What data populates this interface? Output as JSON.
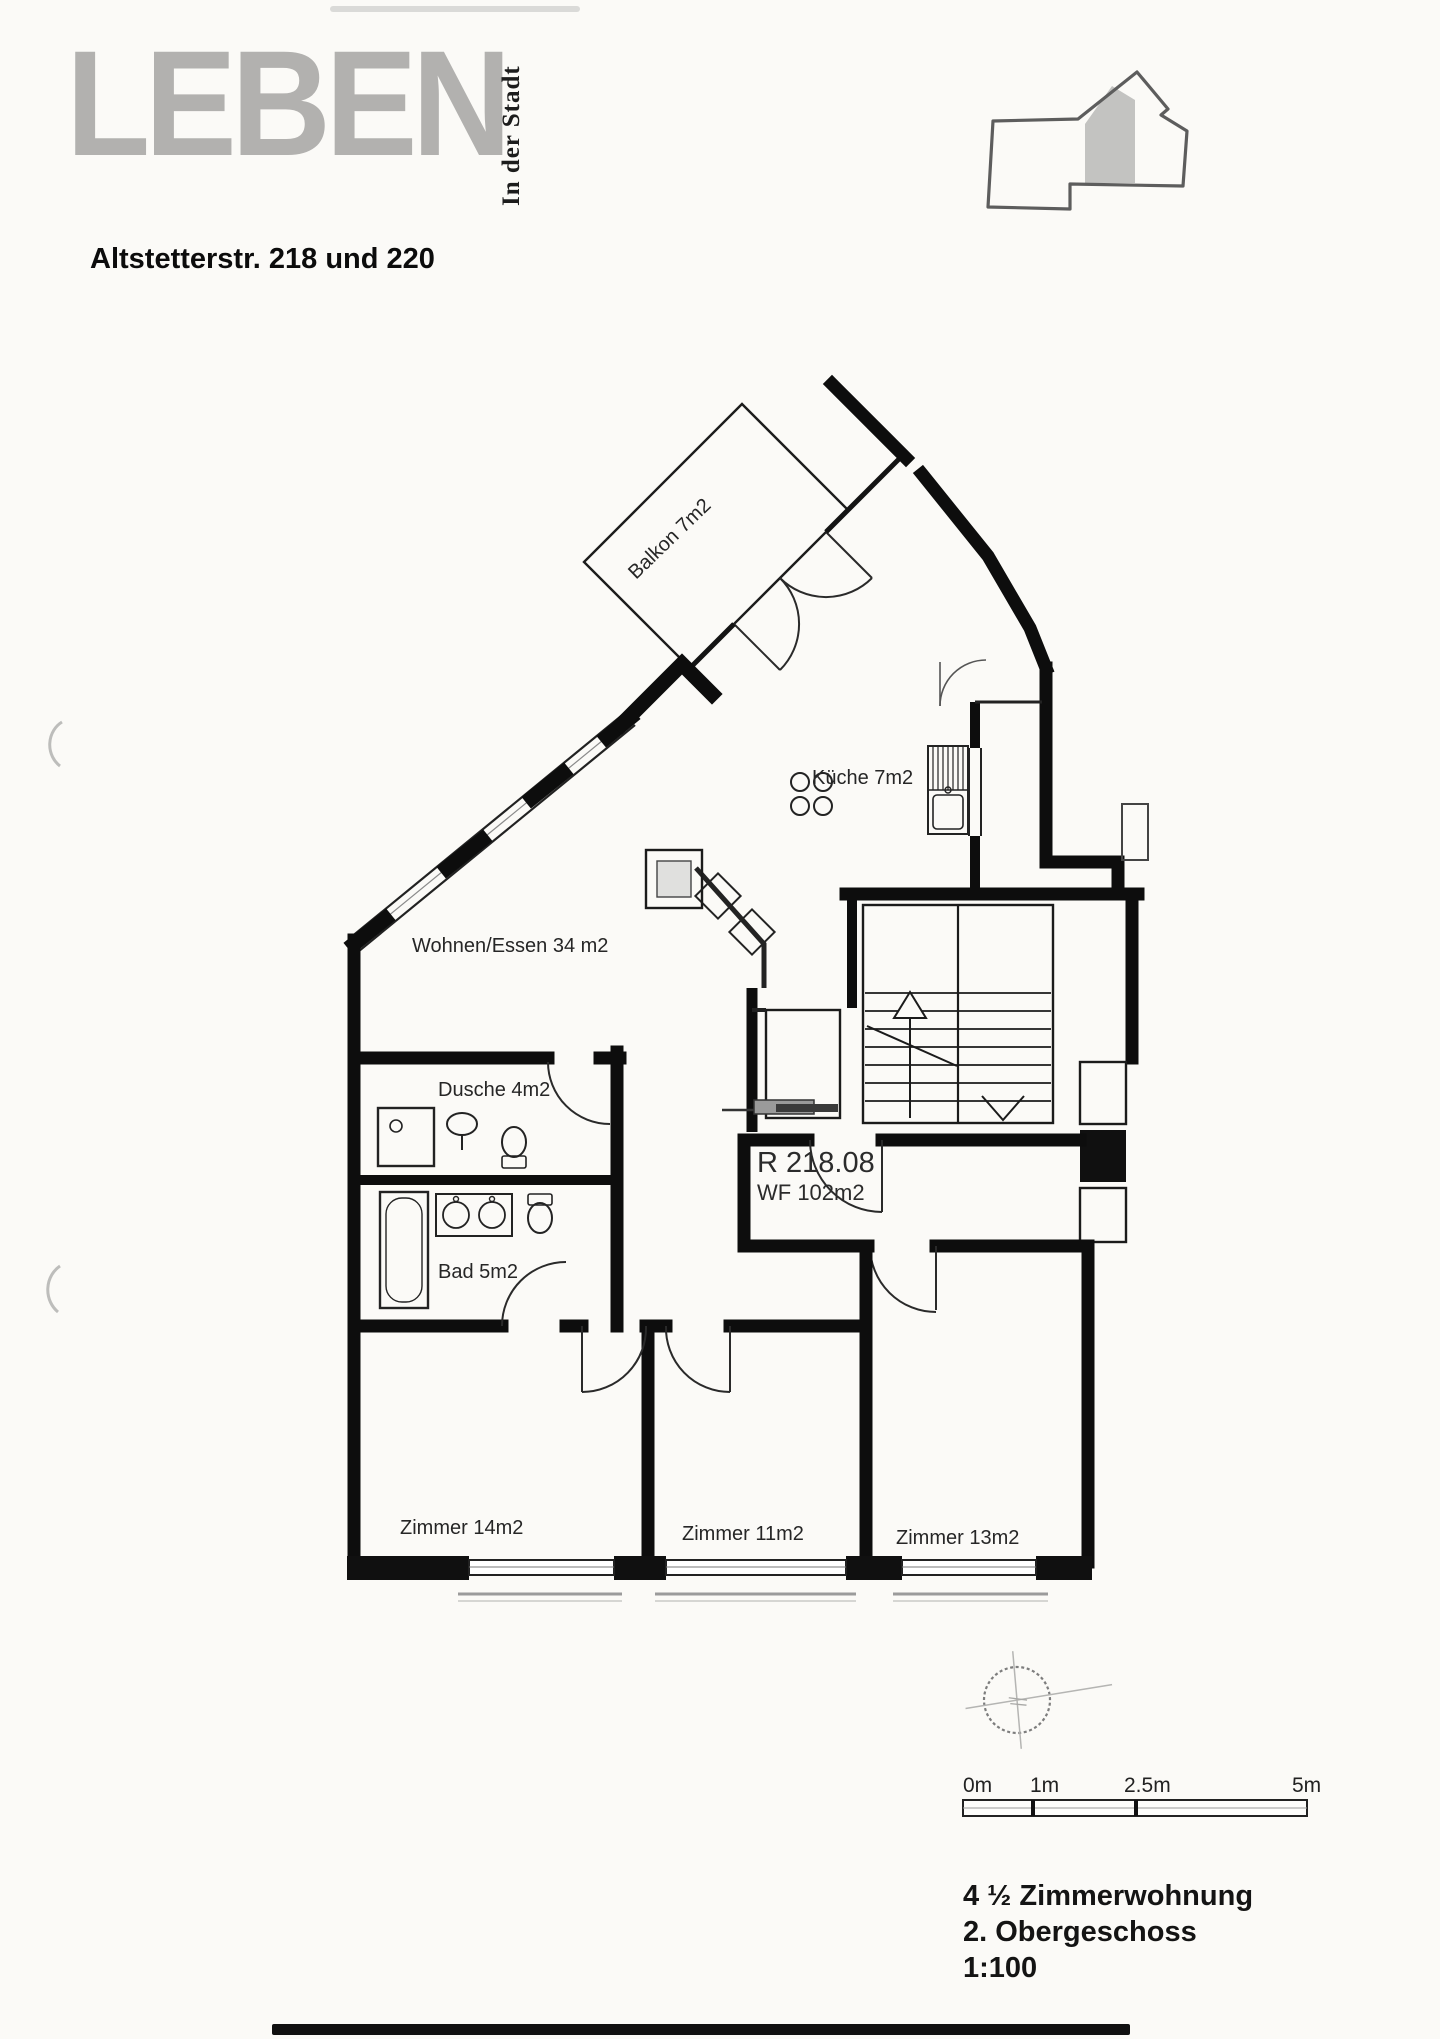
{
  "letterhead": {
    "logo": "LEBEN",
    "tagline": "In der Stadt",
    "address": "Altstetterstr. 218 und 220"
  },
  "plan": {
    "balkon": "Balkon 7m2",
    "kueche": "Küche 7m2",
    "wohnen": "Wohnen/Essen 34 m2",
    "dusche": "Dusche 4m2",
    "bad": "Bad 5m2",
    "zimmer14": "Zimmer 14m2",
    "zimmer11": "Zimmer 11m2",
    "zimmer13": "Zimmer 13m2",
    "unit_code": "R 218.08",
    "unit_area": "WF 102m2"
  },
  "scalebar": {
    "l0": "0m",
    "l1": "1m",
    "l2": "2.5m",
    "l3": "5m"
  },
  "footer": {
    "line1": "4 ½ Zimmerwohnung",
    "line2": "2. Obergeschoss",
    "line3": "1:100"
  },
  "colors": {
    "paper": "#fbfaf7",
    "ink": "#111111",
    "logo_gray": "#b2b1af",
    "sill_gray": "#9b9b9b"
  }
}
